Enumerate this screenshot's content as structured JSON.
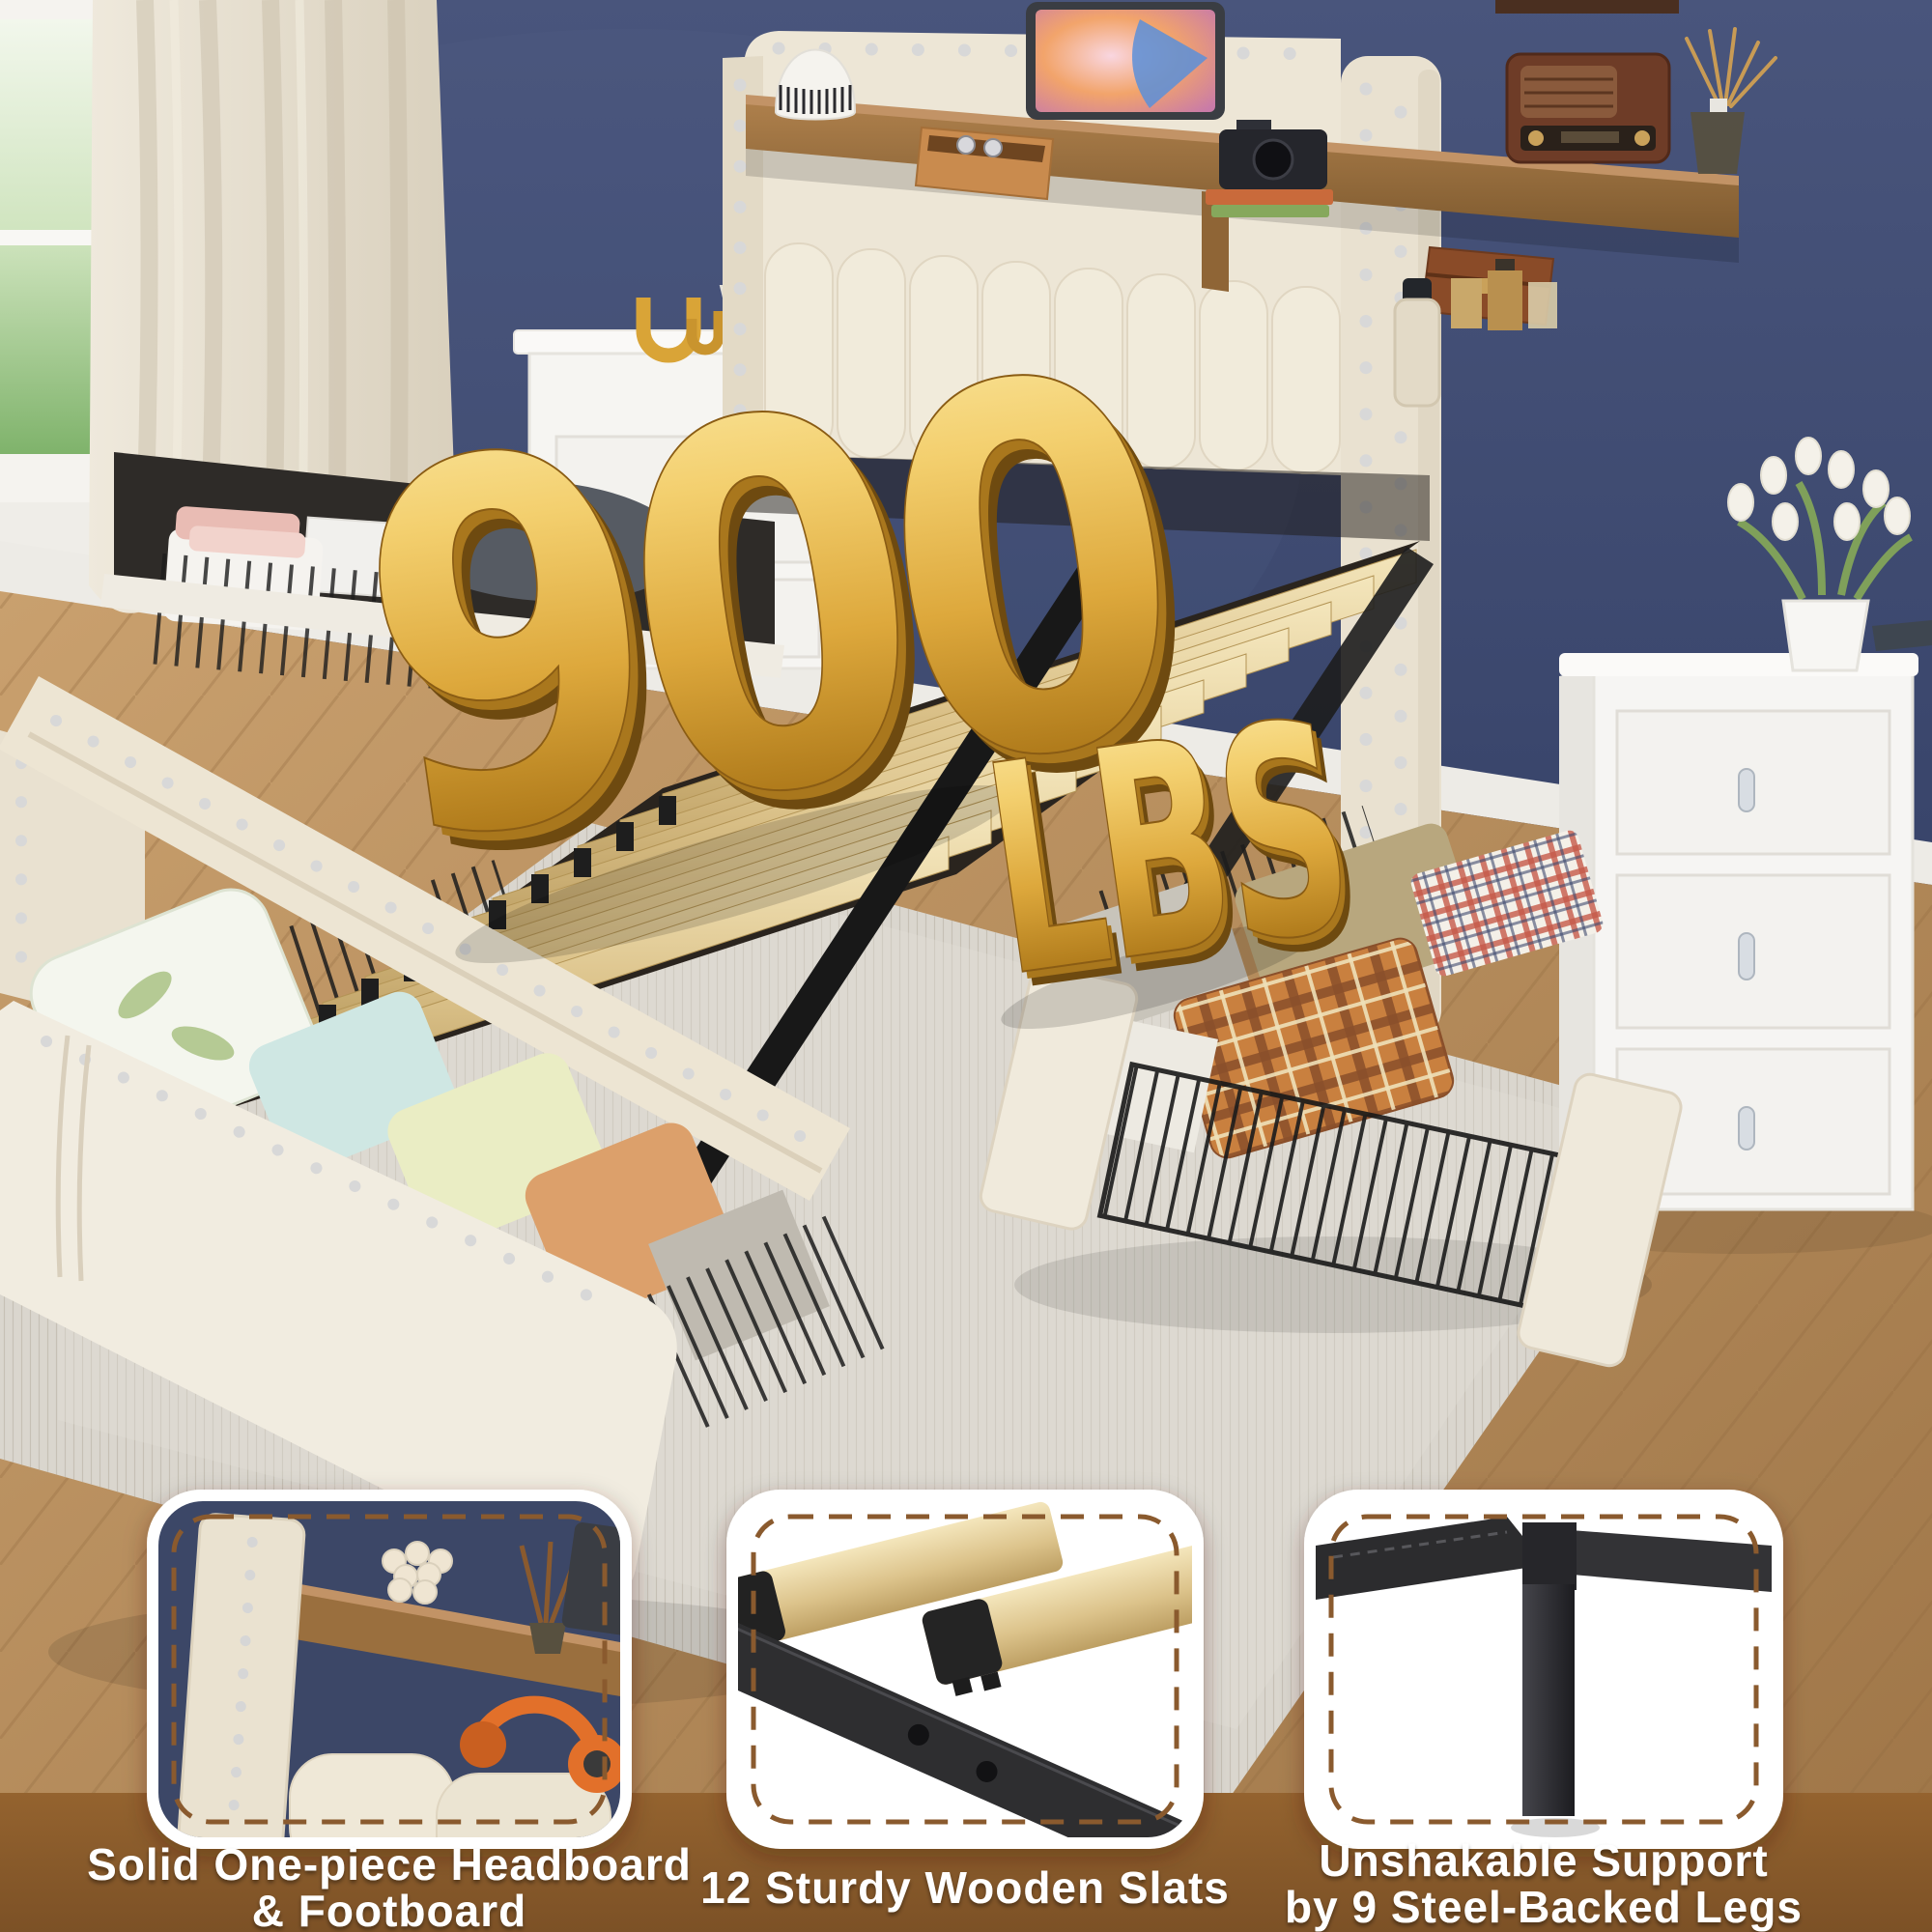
{
  "image": {
    "kind": "product-marketing-photo",
    "subject": "beige upholstered storage bed with headboard shelf, wooden slats and 4 pull-out storage drawers in a navy-wall bedroom"
  },
  "headline": {
    "number": "900",
    "unit": "LBS",
    "meaning": "weight capacity shown as 3D gold text"
  },
  "features": [
    {
      "id": "headboard",
      "image": "headboard-corner-closeup",
      "caption_line1": "Solid One-piece Headboard",
      "caption_line2": "& Footboard"
    },
    {
      "id": "slats",
      "image": "wooden-slats-closeup",
      "caption_line1": "12 Sturdy Wooden Slats",
      "caption_line2": ""
    },
    {
      "id": "legs",
      "image": "steel-leg-closeup",
      "caption_line1": "Unshakable Support",
      "caption_line2": "by 9 Steel-Backed Legs"
    }
  ],
  "colors": {
    "wall_navy": "#3E4A6E",
    "upholstery_beige": "#ECE5D5",
    "slat_wood": "#E3CFA0",
    "shelf_wood": "#9A6F3E",
    "metal_black": "#1F1F1F",
    "gold_light": "#F7DC8B",
    "gold_mid": "#DDA83C",
    "gold_dark": "#8A5C14",
    "floor_wood": "#B98B57",
    "rug_gray": "#D9D5CD",
    "banner_brown": "#8A5A2E",
    "card_white": "#FFFFFF",
    "caption_white": "#FFFFFF"
  }
}
